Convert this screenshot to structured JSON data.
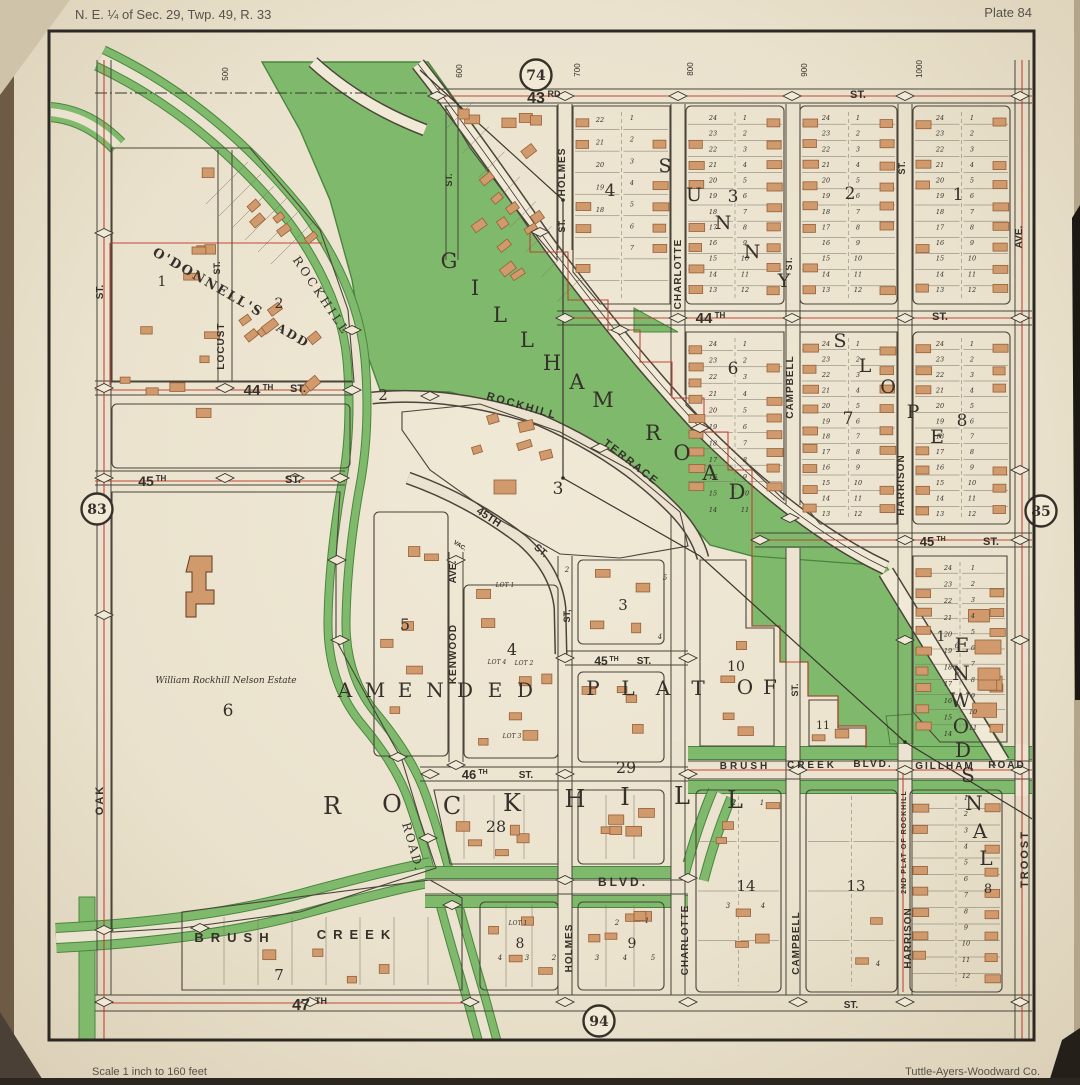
{
  "page": {
    "header_left": "N. E. ¼ of Sec. 29, Twp. 49, R. 33",
    "header_right": "Plate 84",
    "footer_left": "Scale  1 inch to 160 feet",
    "footer_right": "Tuttle-Ayers-Woodward Co."
  },
  "colors": {
    "paper": "#ebe3cf",
    "paper_light": "#f0e9d6",
    "paper_edge": "#d8ccb2",
    "park_green": "#7fba6c",
    "dark_green": "#49853f",
    "ink": "#35302a",
    "line": "#4a443a",
    "lot_line": "#7a7264",
    "red": "#bf3a2b",
    "building": "#d09a6c",
    "building_stroke": "#96603a",
    "border": "#2c2823",
    "photo_edge": "#6d5b45"
  },
  "plate_circles": [
    {
      "label": "74",
      "x": 536,
      "y": 75
    },
    {
      "label": "83",
      "x": 97,
      "y": 509
    },
    {
      "label": "85",
      "x": 1041,
      "y": 511
    },
    {
      "label": "94",
      "x": 599,
      "y": 1021
    }
  ],
  "street_numbers": [
    {
      "t": "500",
      "x": 228,
      "y": 74
    },
    {
      "t": "600",
      "x": 462,
      "y": 71
    },
    {
      "t": "700",
      "x": 580,
      "y": 70
    },
    {
      "t": "800",
      "x": 693,
      "y": 69
    },
    {
      "t": "900",
      "x": 807,
      "y": 70
    },
    {
      "t": "1000",
      "x": 922,
      "y": 69
    }
  ],
  "street_labels": [
    {
      "t": "43",
      "x": 536,
      "y": 103,
      "fs": 16
    },
    {
      "t": "RD",
      "x": 554,
      "y": 97,
      "fs": 9
    },
    {
      "t": "ST.",
      "x": 858,
      "y": 98,
      "fs": 11
    },
    {
      "t": "44",
      "x": 704,
      "y": 323,
      "fs": 15
    },
    {
      "t": "TH",
      "x": 720,
      "y": 318,
      "fs": 8
    },
    {
      "t": "ST.",
      "x": 940,
      "y": 320,
      "fs": 11
    },
    {
      "t": "44",
      "x": 252,
      "y": 395,
      "fs": 15
    },
    {
      "t": "TH",
      "x": 268,
      "y": 390,
      "fs": 8
    },
    {
      "t": "ST.",
      "x": 298,
      "y": 392,
      "fs": 11
    },
    {
      "t": "45",
      "x": 146,
      "y": 486,
      "fs": 14
    },
    {
      "t": "TH",
      "x": 161,
      "y": 481,
      "fs": 8
    },
    {
      "t": "ST.",
      "x": 293,
      "y": 483,
      "fs": 11
    },
    {
      "t": "45TH",
      "x": 487,
      "y": 520,
      "fs": 11,
      "r": 33
    },
    {
      "t": "ST.",
      "x": 539,
      "y": 553,
      "fs": 10,
      "r": 40
    },
    {
      "t": "45",
      "x": 601,
      "y": 665,
      "fs": 12
    },
    {
      "t": "TH",
      "x": 614,
      "y": 661,
      "fs": 7
    },
    {
      "t": "ST.",
      "x": 644,
      "y": 664,
      "fs": 10
    },
    {
      "t": "45",
      "x": 927,
      "y": 546,
      "fs": 13
    },
    {
      "t": "TH",
      "x": 941,
      "y": 541,
      "fs": 7
    },
    {
      "t": "ST.",
      "x": 991,
      "y": 545,
      "fs": 11
    },
    {
      "t": "46",
      "x": 469,
      "y": 779,
      "fs": 13
    },
    {
      "t": "TH",
      "x": 483,
      "y": 774,
      "fs": 7
    },
    {
      "t": "ST.",
      "x": 526,
      "y": 778,
      "fs": 10
    },
    {
      "t": "47",
      "x": 301,
      "y": 1010,
      "fs": 16
    },
    {
      "t": "TH",
      "x": 321,
      "y": 1004,
      "fs": 9
    },
    {
      "t": "ST.",
      "x": 851,
      "y": 1008,
      "fs": 10
    },
    {
      "t": "BRUSH",
      "x": 235,
      "y": 942,
      "fs": 13,
      "ls": 7
    },
    {
      "t": "CREEK",
      "x": 357,
      "y": 939,
      "fs": 13,
      "ls": 7
    },
    {
      "t": "BLVD.",
      "x": 623,
      "y": 886,
      "fs": 12,
      "ls": 3
    },
    {
      "t": "BRUSH",
      "x": 745,
      "y": 769,
      "fs": 10,
      "ls": 3
    },
    {
      "t": "CREEK",
      "x": 812,
      "y": 768,
      "fs": 10,
      "ls": 3
    },
    {
      "t": "BLVD.",
      "x": 873,
      "y": 767,
      "fs": 10,
      "ls": 2
    },
    {
      "t": "GILLHAM",
      "x": 945,
      "y": 769,
      "fs": 10,
      "ls": 2
    },
    {
      "t": "ROAD",
      "x": 1007,
      "y": 768,
      "fs": 10,
      "ls": 2
    },
    {
      "t": "ST.",
      "x": 103,
      "y": 292,
      "r": -90,
      "fs": 10
    },
    {
      "t": "OAK",
      "x": 103,
      "y": 800,
      "r": -90,
      "fs": 11,
      "ls": 2
    },
    {
      "t": "ST.",
      "x": 220,
      "y": 268,
      "r": -90,
      "fs": 9
    },
    {
      "t": "LOCUST",
      "x": 224,
      "y": 346,
      "r": -90,
      "fs": 10,
      "ls": 1
    },
    {
      "t": "AVE.",
      "x": 456,
      "y": 572,
      "r": -90,
      "fs": 10
    },
    {
      "t": "KENWOOD",
      "x": 456,
      "y": 654,
      "r": -90,
      "fs": 10,
      "ls": 1
    },
    {
      "t": "HOLMES",
      "x": 565,
      "y": 172,
      "r": -90,
      "fs": 10,
      "ls": 1
    },
    {
      "t": "ST.",
      "x": 565,
      "y": 226,
      "r": -90,
      "fs": 9
    },
    {
      "t": "ST,",
      "x": 570,
      "y": 616,
      "r": -90,
      "fs": 9
    },
    {
      "t": "HOLMES",
      "x": 572,
      "y": 948,
      "r": -90,
      "fs": 10,
      "ls": 1
    },
    {
      "t": "CHARLOTTE",
      "x": 681,
      "y": 274,
      "r": -90,
      "fs": 10,
      "ls": 1
    },
    {
      "t": "CHARLOTTE",
      "x": 688,
      "y": 940,
      "r": -90,
      "fs": 10,
      "ls": 1
    },
    {
      "t": "ST.",
      "x": 792,
      "y": 264,
      "r": -90,
      "fs": 9
    },
    {
      "t": "CAMPBELL",
      "x": 793,
      "y": 387,
      "r": -90,
      "fs": 10,
      "ls": 1
    },
    {
      "t": "ST.",
      "x": 798,
      "y": 690,
      "r": -90,
      "fs": 9
    },
    {
      "t": "CAMPBELL",
      "x": 799,
      "y": 943,
      "r": -90,
      "fs": 10,
      "ls": 1
    },
    {
      "t": "ST.",
      "x": 905,
      "y": 168,
      "r": -90,
      "fs": 9
    },
    {
      "t": "HARRISON",
      "x": 904,
      "y": 485,
      "r": -90,
      "fs": 10,
      "ls": 1
    },
    {
      "t": "HARRISON",
      "x": 911,
      "y": 938,
      "r": -90,
      "fs": 10,
      "ls": 1
    },
    {
      "t": "AVE.",
      "x": 1022,
      "y": 237,
      "r": -90,
      "fs": 10
    },
    {
      "t": "TROOST",
      "x": 1028,
      "y": 859,
      "r": -90,
      "fs": 11,
      "ls": 2
    },
    {
      "t": "ST.",
      "x": 452,
      "y": 180,
      "r": -90,
      "fs": 9
    },
    {
      "t": "ROCKHILL",
      "x": 318,
      "y": 298,
      "r": 56,
      "fs": 12,
      "ls": 3,
      "f": "serif"
    },
    {
      "t": "ROAD.",
      "x": 409,
      "y": 848,
      "r": 74,
      "fs": 12,
      "ls": 2,
      "f": "serif"
    },
    {
      "t": "ROCKHILL",
      "x": 521,
      "y": 409,
      "r": 16,
      "fs": 11,
      "ls": 2
    },
    {
      "t": "TERRACE",
      "x": 629,
      "y": 465,
      "r": 38,
      "fs": 11,
      "ls": 2
    },
    {
      "t": "O'DONNELL'S",
      "x": 206,
      "y": 286,
      "r": 30,
      "fs": 13,
      "ls": 2,
      "f": "serif",
      "w": 700
    },
    {
      "t": "ADD",
      "x": 291,
      "y": 339,
      "r": 30,
      "fs": 12,
      "ls": 2,
      "f": "serif",
      "w": 700
    },
    {
      "t": "VAC.",
      "x": 459,
      "y": 547,
      "fs": 6,
      "r": 33
    },
    {
      "t": "2ND PLAT OF ROCKHILL",
      "x": 906,
      "y": 842,
      "r": -90,
      "fs": 7,
      "ls": 1
    },
    {
      "t": "William Rockhill Nelson Estate",
      "x": 226,
      "y": 683,
      "fs": 9,
      "f": "serif",
      "i": 1,
      "w": 400
    },
    {
      "t": "LOT 4",
      "x": 497,
      "y": 664,
      "fs": 6,
      "i": 1,
      "f": "serif",
      "w": 400
    },
    {
      "t": "LOT 2",
      "x": 524,
      "y": 665,
      "fs": 6,
      "i": 1,
      "f": "serif",
      "w": 400
    },
    {
      "t": "LOT 3",
      "x": 512,
      "y": 738,
      "fs": 6,
      "i": 1,
      "f": "serif",
      "w": 400
    },
    {
      "t": "LOT 1",
      "x": 518,
      "y": 925,
      "fs": 6,
      "i": 1,
      "f": "serif",
      "w": 400
    },
    {
      "t": "LOT 1",
      "x": 505,
      "y": 587,
      "fs": 6,
      "i": 1,
      "f": "serif",
      "w": 400
    }
  ],
  "big_words": [
    {
      "chars": "GILLHAM",
      "fs": 21,
      "pts": [
        [
          449,
          268
        ],
        [
          475,
          295
        ],
        [
          500,
          322
        ],
        [
          527,
          347
        ],
        [
          552,
          370
        ],
        [
          577,
          389
        ],
        [
          603,
          407
        ]
      ]
    },
    {
      "chars": "ROAD",
      "fs": 21,
      "pts": [
        [
          653,
          440
        ],
        [
          682,
          460
        ],
        [
          710,
          480
        ],
        [
          737,
          499
        ]
      ]
    },
    {
      "chars": "SUNNY",
      "fs": 19,
      "pts": [
        [
          665,
          172
        ],
        [
          694,
          201
        ],
        [
          723,
          229
        ],
        [
          752,
          258
        ],
        [
          784,
          287
        ]
      ]
    },
    {
      "chars": "SLOPE",
      "fs": 19,
      "pts": [
        [
          840,
          347
        ],
        [
          865,
          372
        ],
        [
          888,
          393
        ],
        [
          913,
          418
        ],
        [
          937,
          443
        ]
      ]
    },
    {
      "chars": "AMENDED",
      "fs": 20,
      "pts": [
        [
          345,
          697
        ],
        [
          375,
          697
        ],
        [
          405,
          697
        ],
        [
          435,
          697
        ],
        [
          465,
          697
        ],
        [
          495,
          697
        ],
        [
          525,
          697
        ]
      ]
    },
    {
      "chars": "PLAT",
      "fs": 20,
      "pts": [
        [
          593,
          695
        ],
        [
          628,
          695
        ],
        [
          663,
          695
        ],
        [
          698,
          695
        ]
      ]
    },
    {
      "chars": "OF",
      "fs": 20,
      "pts": [
        [
          745,
          694
        ],
        [
          770,
          694
        ]
      ]
    },
    {
      "chars": "ROCKHILL",
      "fs": 24,
      "pts": [
        [
          332,
          814
        ],
        [
          392,
          812
        ],
        [
          452,
          814
        ],
        [
          512,
          811
        ],
        [
          575,
          807
        ],
        [
          625,
          805
        ],
        [
          682,
          804
        ],
        [
          735,
          808
        ]
      ]
    },
    {
      "chars": "ENWODSNAL",
      "fs": 20,
      "pts": [
        [
          962,
          652
        ],
        [
          961,
          680
        ],
        [
          960,
          707
        ],
        [
          961,
          733
        ],
        [
          963,
          757
        ],
        [
          968,
          782
        ],
        [
          974,
          810
        ],
        [
          980,
          838
        ],
        [
          986,
          865
        ]
      ]
    }
  ],
  "block_numbers": [
    {
      "t": "1",
      "x": 958,
      "y": 200
    },
    {
      "t": "2",
      "x": 850,
      "y": 199
    },
    {
      "t": "3",
      "x": 733,
      "y": 202
    },
    {
      "t": "4",
      "x": 610,
      "y": 196
    },
    {
      "t": "6",
      "x": 733,
      "y": 374
    },
    {
      "t": "7",
      "x": 848,
      "y": 424
    },
    {
      "t": "8",
      "x": 962,
      "y": 426
    },
    {
      "t": "1",
      "x": 162,
      "y": 286,
      "fs": 14
    },
    {
      "t": "2",
      "x": 279,
      "y": 308,
      "fs": 14
    },
    {
      "t": "2",
      "x": 383,
      "y": 400,
      "fs": 15
    },
    {
      "t": "3",
      "x": 558,
      "y": 494
    },
    {
      "t": "3",
      "x": 623,
      "y": 610,
      "fs": 15
    },
    {
      "t": "4",
      "x": 512,
      "y": 655,
      "fs": 16
    },
    {
      "t": "5",
      "x": 405,
      "y": 630,
      "fs": 16
    },
    {
      "t": "6",
      "x": 228,
      "y": 716
    },
    {
      "t": "10",
      "x": 736,
      "y": 671,
      "fs": 14
    },
    {
      "t": "11",
      "x": 823,
      "y": 729,
      "fs": 11
    },
    {
      "t": "29",
      "x": 626,
      "y": 773,
      "fs": 16
    },
    {
      "t": "28",
      "x": 496,
      "y": 832,
      "fs": 16
    },
    {
      "t": "14",
      "x": 746,
      "y": 891,
      "fs": 15
    },
    {
      "t": "13",
      "x": 856,
      "y": 891,
      "fs": 15
    },
    {
      "t": "7",
      "x": 279,
      "y": 980,
      "fs": 15
    },
    {
      "t": "8",
      "x": 520,
      "y": 948,
      "fs": 14
    },
    {
      "t": "9",
      "x": 632,
      "y": 948,
      "fs": 14
    },
    {
      "t": "8",
      "x": 988,
      "y": 893,
      "fs": 13
    },
    {
      "t": "1",
      "x": 941,
      "y": 641,
      "fs": 14
    }
  ],
  "small_numbers": [
    {
      "t": "4",
      "x": 500,
      "y": 960
    },
    {
      "t": "3",
      "x": 527,
      "y": 960
    },
    {
      "t": "2",
      "x": 554,
      "y": 960
    },
    {
      "t": "3",
      "x": 597,
      "y": 960
    },
    {
      "t": "4",
      "x": 625,
      "y": 960
    },
    {
      "t": "5",
      "x": 653,
      "y": 960
    },
    {
      "t": "2",
      "x": 617,
      "y": 925
    },
    {
      "t": "1",
      "x": 647,
      "y": 923
    },
    {
      "t": "3",
      "x": 728,
      "y": 908
    },
    {
      "t": "4",
      "x": 763,
      "y": 908
    },
    {
      "t": "2",
      "x": 567,
      "y": 572
    },
    {
      "t": "5",
      "x": 665,
      "y": 580
    },
    {
      "t": "4",
      "x": 660,
      "y": 639
    },
    {
      "t": "2",
      "x": 734,
      "y": 805
    },
    {
      "t": "1",
      "x": 762,
      "y": 805
    },
    {
      "t": "4",
      "x": 878,
      "y": 966
    },
    {
      "t": "5",
      "x": 957,
      "y": 675
    },
    {
      "t": "6",
      "x": 957,
      "y": 648
    }
  ],
  "lot_cols": [
    {
      "x": 713,
      "y0": 120,
      "y1": 292,
      "from": 24,
      "to": 13
    },
    {
      "x": 745,
      "y0": 120,
      "y1": 292,
      "from": 1,
      "to": 12
    },
    {
      "x": 826,
      "y0": 120,
      "y1": 292,
      "from": 24,
      "to": 13
    },
    {
      "x": 858,
      "y0": 120,
      "y1": 292,
      "from": 1,
      "to": 12
    },
    {
      "x": 940,
      "y0": 120,
      "y1": 292,
      "from": 24,
      "to": 13
    },
    {
      "x": 972,
      "y0": 120,
      "y1": 292,
      "from": 1,
      "to": 12
    },
    {
      "x": 600,
      "y0": 122,
      "y1": 212,
      "from": 22,
      "to": 18
    },
    {
      "x": 632,
      "y0": 120,
      "y1": 250,
      "from": 1,
      "to": 7
    },
    {
      "x": 713,
      "y0": 346,
      "y1": 512,
      "from": 24,
      "to": 14
    },
    {
      "x": 745,
      "y0": 346,
      "y1": 512,
      "from": 1,
      "to": 11
    },
    {
      "x": 826,
      "y0": 346,
      "y1": 516,
      "from": 24,
      "to": 13
    },
    {
      "x": 858,
      "y0": 346,
      "y1": 516,
      "from": 1,
      "to": 12
    },
    {
      "x": 940,
      "y0": 346,
      "y1": 516,
      "from": 24,
      "to": 13
    },
    {
      "x": 972,
      "y0": 346,
      "y1": 516,
      "from": 1,
      "to": 12
    },
    {
      "x": 948,
      "y0": 570,
      "y1": 736,
      "from": 24,
      "to": 14
    },
    {
      "x": 973,
      "y0": 570,
      "y1": 730,
      "from": 1,
      "to": 11
    },
    {
      "x": 966,
      "y0": 800,
      "y1": 978,
      "from": 1,
      "to": 12
    }
  ]
}
